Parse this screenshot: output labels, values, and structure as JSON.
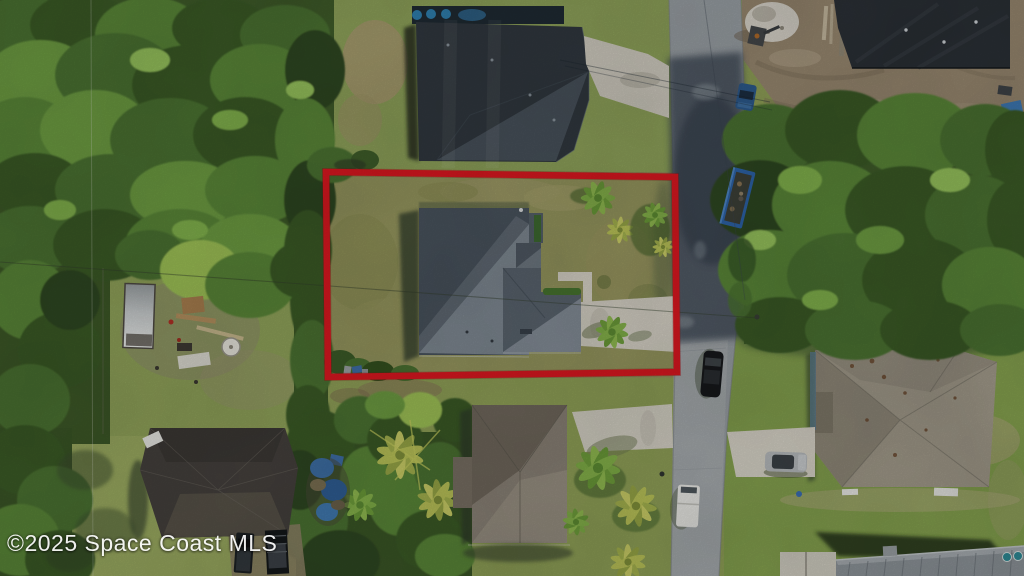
{
  "watermark": {
    "text": "©2025 Space Coast MLS"
  },
  "colors": {
    "red_outline": "#dc1820",
    "watermark_text": "#ffffff",
    "grass_base": "#8fa057",
    "forest": "#3f5c2a",
    "road": "#9aa0a5",
    "concrete": "#d4d0c4",
    "dirt": "#97876f",
    "subject_roof_dark": "#4a545e",
    "subject_roof_light": "#7e8892",
    "top_neighbor_roof": "#31383f",
    "bottom_center_roof": "#8a8276",
    "bottom_left_roof": "#45413d",
    "bottom_right_roof": "#a19a8a",
    "construction_roof": "#2b3036",
    "metal_roof": "#8d9499",
    "trailer_blue": "#2e64a8"
  },
  "scene": {
    "kind": "aerial-real-estate-photo",
    "highlight": "red-property-boundary"
  }
}
